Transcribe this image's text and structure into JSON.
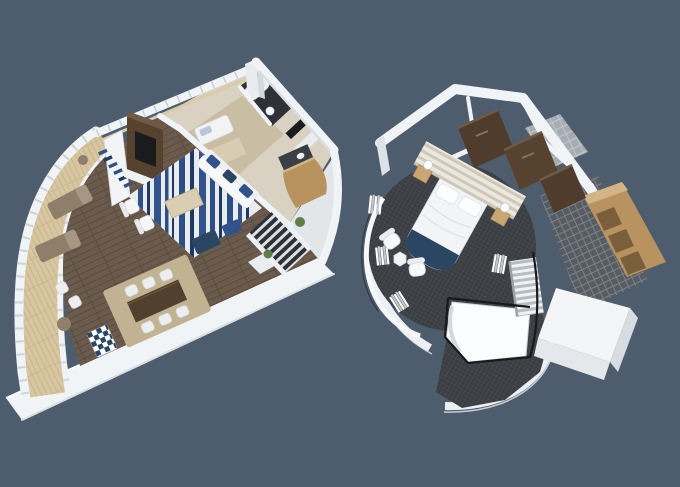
{
  "scene": {
    "kind": "3d-floorplan-render",
    "description": "Two isometric 3D cutaway floor plans of a two-level loft suite on a plain slate background",
    "left_plan": {
      "name": "lower-level-living-area",
      "features": [
        "curved-balcony-with-loungers",
        "wraparound-white-railing",
        "wood-plank-floor",
        "blue-pattern-rug",
        "white-sofa-blue-cushions",
        "tv-media-wall",
        "wall-shelving-blue-decor",
        "dining-table-six-white-chairs",
        "bathroom-with-tub",
        "kitchenette-bar",
        "l-shaped-staircase",
        "checkered-armchair"
      ]
    },
    "right_plan": {
      "name": "upper-level-master-bedroom",
      "features": [
        "circular-bedroom-charcoal-carpet",
        "bed-with-navy-runner",
        "striped-headboard-wall",
        "walnut-wardrobe-panels",
        "nightstands-with-lamps",
        "two-white-armchairs-side-table",
        "curtained-glass-wall",
        "stair-void-with-black-railing",
        "mosaic-tile-bathroom-floor",
        "oak-shelving-unit"
      ]
    }
  },
  "colors": {
    "background": "#4e5d6d",
    "wall": "#f1f4f6",
    "wallShade": "#d9dee2",
    "wallFace": "#dde2e6",
    "woodFloor": "#6b5b4d",
    "woodSeam": "#5a4b3e",
    "deck": "#d8c6a1",
    "deckSeam": "#c7b38b",
    "carpet": "#3a3e42",
    "carpetLine": "#464a4f",
    "tileDark": "#565c62",
    "tileGrout": "#7d8388",
    "tileLight": "#a6acb1",
    "tileLightGrout": "#c3c8cc",
    "oak": "#b8935f",
    "oakLight": "#d2b586",
    "oakDark": "#7a5f3c",
    "walnut": "#4f3c2c",
    "walnutLight": "#6f5a45",
    "navy": "#2b4663",
    "sofaBlue": "#31538a",
    "rugBlueDeep": "#1e3a63",
    "rugBlue": "#2c4f86",
    "rugWhite": "#e9ebee",
    "beigeCarpet": "#c9bda3",
    "beigeRug": "#d8cdb4",
    "diningRug": "#c1b292",
    "tableWood": "#52402f",
    "mediaWood": "#57422f",
    "lounger": "#8f7e6a",
    "loungerLight": "#a79681",
    "plant": "#5d7d49",
    "railingBlack": "#17191b",
    "bedWhite": "#f2f4f6",
    "pillow": "#fcfdfe",
    "headboardA": "#ece8dd",
    "headboardB": "#cfc8b8",
    "stairDark": "#2e3236",
    "stairLight": "#dde1e4",
    "screenDark": "#191b1d",
    "counterDark": "#3b3f44",
    "bathFloor": "#2e3236"
  }
}
